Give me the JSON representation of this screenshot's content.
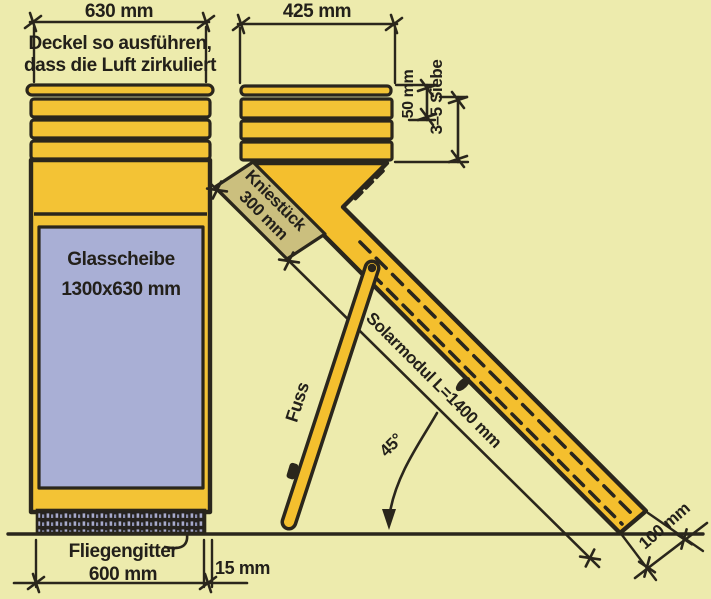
{
  "diagram": {
    "box": {
      "width_dim": "630 mm",
      "lid_note_1": "Deckel so ausführen,",
      "lid_note_2": "dass die Luft zirkuliert",
      "glass_1": "Glasscheibe",
      "glass_2": "1300x630 mm",
      "mesh_1": "Fliegengitter",
      "mesh_2": "600 mm",
      "gap_dim": "15 mm"
    },
    "collector": {
      "width_dim": "425 mm",
      "spacing_dim": "50 mm",
      "sieves_dim": "3–5 Siebe",
      "knee_1": "Kniestück",
      "knee_2": "300 mm",
      "module_dim": "Solarmodul L=1400 mm",
      "angle_dim": "45°",
      "thickness_dim": "100 mm",
      "foot_label": "Fuss"
    },
    "colors": {
      "background": "#EDEBAD",
      "wood_yellow": "#F3C335",
      "module_yellow": "#F4BF2E",
      "glass_blue": "#A9AFD5",
      "knee_khaki": "#CBBF7E",
      "ink": "#2A261C",
      "mesh_dark": "#26231F",
      "mesh_dot": "#A8ABCC"
    }
  }
}
